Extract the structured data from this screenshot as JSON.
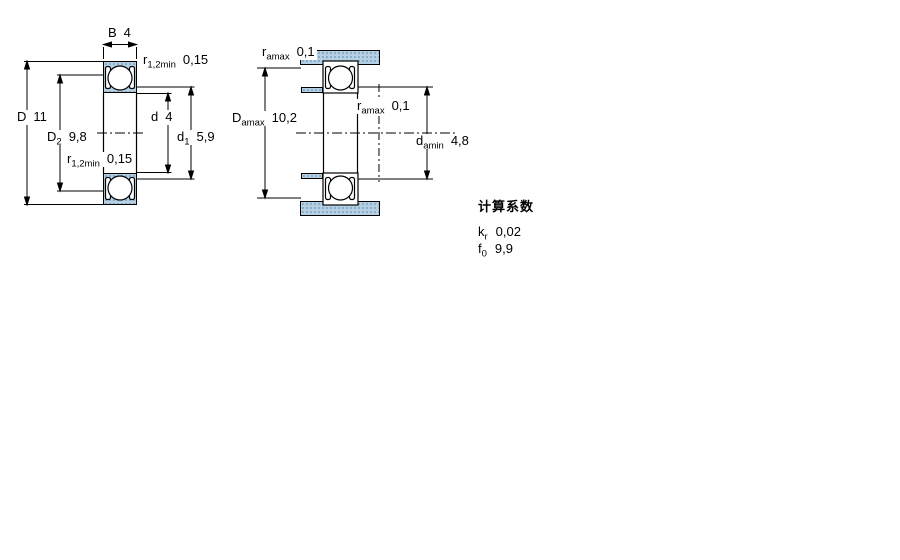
{
  "left_view": {
    "labels": {
      "width": {
        "symbol": "B",
        "value": "4"
      },
      "outer_dia": {
        "symbol": "D",
        "value": "11"
      },
      "d2": {
        "symbol": "D",
        "sub": "2",
        "value": "9,8"
      },
      "r_top": {
        "symbol": "r",
        "sub": "1,2min",
        "value": "0,15"
      },
      "r_bottom": {
        "symbol": "r",
        "sub": "1,2min",
        "value": "0,15"
      },
      "bore": {
        "symbol": "d",
        "value": "4"
      },
      "d1": {
        "symbol": "d",
        "sub": "1",
        "value": "5,9"
      }
    }
  },
  "right_view": {
    "labels": {
      "ra_top": {
        "symbol": "r",
        "sub": "amax",
        "value": "0,1"
      },
      "da_max": {
        "symbol": "D",
        "sub": "amax",
        "value": "10,2"
      },
      "ra_mid": {
        "symbol": "r",
        "sub": "amax",
        "value": "0,1"
      },
      "da_min": {
        "symbol": "d",
        "sub": "amin",
        "value": "4,8"
      }
    }
  },
  "calculation_factors": {
    "title": "计算系数",
    "rows": [
      {
        "symbol": "k",
        "sub": "r",
        "value": "0,02"
      },
      {
        "symbol": "f",
        "sub": "0",
        "value": "9,9"
      }
    ]
  },
  "colors": {
    "section_fill": "#b5d0e2",
    "section_dot": "#7ba3c0",
    "line": "#000000"
  }
}
